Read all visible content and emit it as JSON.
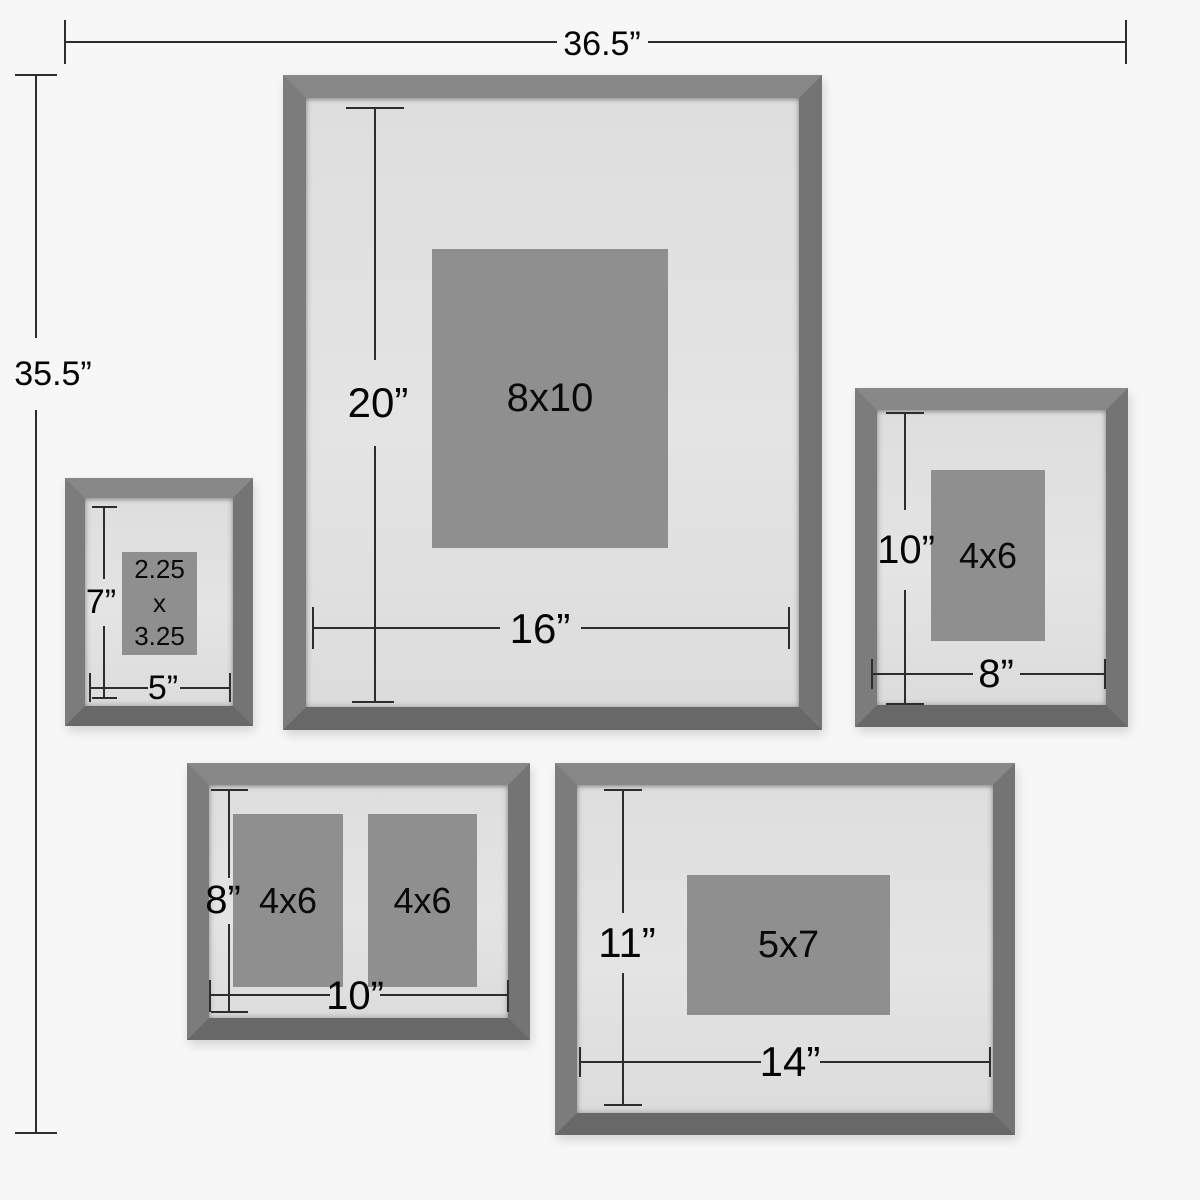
{
  "diagram": {
    "overall": {
      "width": "36.5”",
      "height": "35.5”"
    },
    "frames": [
      {
        "height": "20”",
        "width": "16”",
        "openings": [
          "8x10"
        ]
      },
      {
        "height": "7”",
        "width": "5”",
        "openings": [
          "2.25",
          "x",
          "3.25"
        ]
      },
      {
        "height": "10”",
        "width": "8”",
        "openings": [
          "4x6"
        ]
      },
      {
        "height": "8”",
        "width": "10”",
        "openings": [
          "4x6",
          "4x6"
        ]
      },
      {
        "height": "11”",
        "width": "14”",
        "openings": [
          "5x7"
        ]
      }
    ],
    "colors": {
      "background": "#f7f7f7",
      "frame_wood": "#7a7a7a",
      "mat": "#e2e2e2",
      "photo_placeholder": "#8f8f8f",
      "dimension_line": "#2d2d2d"
    }
  }
}
